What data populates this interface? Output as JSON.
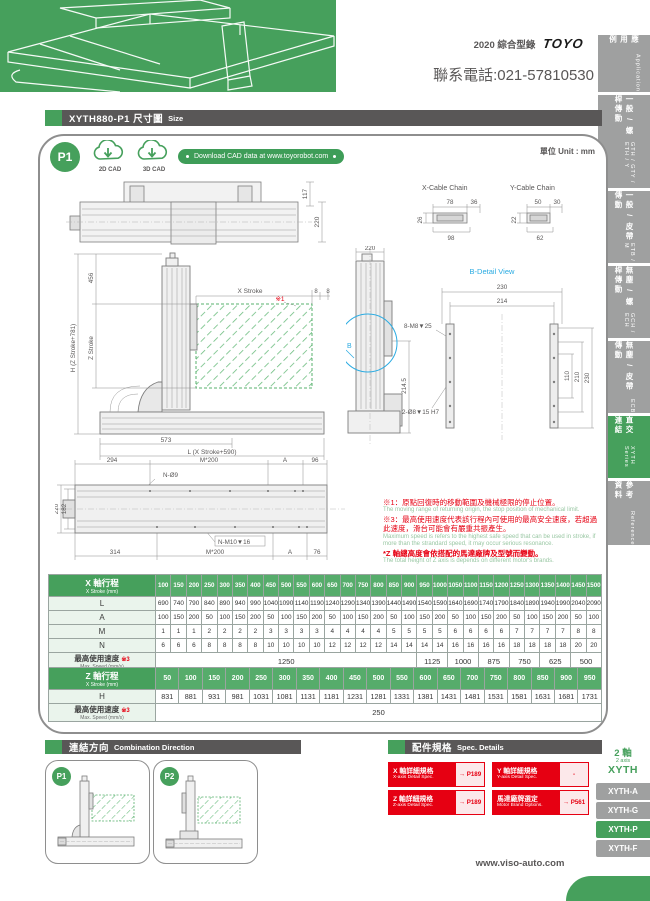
{
  "header": {
    "catalog": "2020 綜合型錄",
    "logo": "TOYO",
    "phone": "聯系電話:021-57810530"
  },
  "sidebar": {
    "items": [
      {
        "cn": "應用例",
        "en": "Application"
      },
      {
        "cn": "一般 / 螺桿傳動",
        "en": "GTH / GTY / ETH / Y"
      },
      {
        "cn": "一般 / 皮帶傳動",
        "en": "ETB / M"
      },
      {
        "cn": "無塵 / 螺桿傳動",
        "en": "GCH / ECH"
      },
      {
        "cn": "無塵 / 皮帶傳動",
        "en": "ECB"
      },
      {
        "cn": "直交連結",
        "en": "XYTH Series"
      },
      {
        "cn": "參考資料",
        "en": "Reference"
      }
    ]
  },
  "title_bar": {
    "model_label": "XYTH880-P1 尺寸圖",
    "en": "Size"
  },
  "panel_top": {
    "badge": "P1",
    "cad_2d": "2D CAD",
    "cad_3d": "3D CAD",
    "download": "Download CAD data at www.toyorobot.com",
    "unit": "單位 Unit : mm"
  },
  "drawings": {
    "top": {
      "d117": "117",
      "d220": "220"
    },
    "cable": {
      "x_title": "X-Cable Chain",
      "y_title": "Y-Cable Chain",
      "x78": "78",
      "x36": "36",
      "x26": "26",
      "x98": "98",
      "y50": "50",
      "y30": "30",
      "y22": "22",
      "y62": "62"
    },
    "front": {
      "d456": "456",
      "dH": "H (Z Stroke+781)",
      "dZ": "Z Stroke",
      "dX": "X Stroke",
      "mark": "※1",
      "d8a": "8",
      "d8b": "8",
      "d573": "573",
      "dL": "L (X Stroke+590)"
    },
    "side": {
      "d220": "220",
      "b": "B",
      "d2145": "214.5"
    },
    "bdetail": {
      "title": "B-Detail View",
      "d230t": "230",
      "d214": "214",
      "c1": "8-M8▼25",
      "c2": "2-Ø8▼15 H7",
      "d110": "110",
      "d210": "210",
      "d230r": "230"
    },
    "base": {
      "d294": "294",
      "m200t": "M*200",
      "at": "A",
      "d96": "96",
      "n9": "N-Ø9",
      "d220": "220",
      "d182": "182",
      "d314": "314",
      "m200b": "M*200",
      "ab": "A",
      "d76": "76",
      "nm10": "N-M10▼16"
    }
  },
  "notes": {
    "n1_cn": "※1：原點回復時的移動範圍及機械極限的停止位置。",
    "n1_en": "The moving range of returning origin, the stop position of mechanical limit.",
    "n3_cn": "※3：最高使用速度代表該行程內可使用的最高安全速度，若超過此速度，滑台可能會有嚴重共振產生。",
    "n3_en": "Maximum speed is refers to the highest safe speed that can be used in stroke, if more than the strandard speed, it may occur serious resonance.",
    "nz_cn": "*Z 軸總高度會依搭配的馬達廠牌及型號而變動。",
    "nz_en": "The total height of Z axis is depends on different motor's brands."
  },
  "x_table": {
    "header": "X 軸行程",
    "header_sub": "X Stroke (mm)",
    "strokes": [
      "100",
      "150",
      "200",
      "250",
      "300",
      "350",
      "400",
      "450",
      "500",
      "550",
      "600",
      "650",
      "700",
      "750",
      "800",
      "850",
      "900",
      "950",
      "1000",
      "1050",
      "1100",
      "1150",
      "1200",
      "1250",
      "1300",
      "1350",
      "1400",
      "1450",
      "1500"
    ],
    "rows": [
      {
        "label": "L",
        "values": [
          "690",
          "740",
          "790",
          "840",
          "890",
          "940",
          "990",
          "1040",
          "1090",
          "1140",
          "1190",
          "1240",
          "1290",
          "1340",
          "1390",
          "1440",
          "1490",
          "1540",
          "1590",
          "1640",
          "1690",
          "1740",
          "1790",
          "1840",
          "1890",
          "1940",
          "1990",
          "2040",
          "2090"
        ]
      },
      {
        "label": "A",
        "values": [
          "100",
          "150",
          "200",
          "50",
          "100",
          "150",
          "200",
          "50",
          "100",
          "150",
          "200",
          "50",
          "100",
          "150",
          "200",
          "50",
          "100",
          "150",
          "200",
          "50",
          "100",
          "150",
          "200",
          "50",
          "100",
          "150",
          "200",
          "50",
          "100"
        ]
      },
      {
        "label": "M",
        "values": [
          "1",
          "1",
          "1",
          "2",
          "2",
          "2",
          "2",
          "3",
          "3",
          "3",
          "3",
          "4",
          "4",
          "4",
          "4",
          "5",
          "5",
          "5",
          "5",
          "6",
          "6",
          "6",
          "6",
          "7",
          "7",
          "7",
          "7",
          "8",
          "8"
        ]
      },
      {
        "label": "N",
        "values": [
          "6",
          "6",
          "6",
          "8",
          "8",
          "8",
          "8",
          "10",
          "10",
          "10",
          "10",
          "12",
          "12",
          "12",
          "12",
          "14",
          "14",
          "14",
          "14",
          "16",
          "16",
          "16",
          "16",
          "18",
          "18",
          "18",
          "18",
          "20",
          "20"
        ]
      }
    ],
    "speed_label": "最高使用速度",
    "speed_mark": "※3",
    "speed_sub": "Max. Speed (mm/s)",
    "speed_cells": [
      {
        "value": "1250",
        "span": 17
      },
      {
        "value": "1125",
        "span": 2
      },
      {
        "value": "1000",
        "span": 2
      },
      {
        "value": "875",
        "span": 2
      },
      {
        "value": "750",
        "span": 2
      },
      {
        "value": "625",
        "span": 2
      },
      {
        "value": "500",
        "span": 2
      }
    ]
  },
  "z_table": {
    "header": "Z 軸行程",
    "header_sub": "X Stroke (mm)",
    "strokes": [
      "50",
      "100",
      "150",
      "200",
      "250",
      "300",
      "350",
      "400",
      "450",
      "500",
      "550",
      "600",
      "650",
      "700",
      "750",
      "800",
      "850",
      "900",
      "950"
    ],
    "rows": [
      {
        "label": "H",
        "values": [
          "831",
          "881",
          "931",
          "981",
          "1031",
          "1081",
          "1131",
          "1181",
          "1231",
          "1281",
          "1331",
          "1381",
          "1431",
          "1481",
          "1531",
          "1581",
          "1631",
          "1681",
          "1731"
        ]
      }
    ],
    "speed_label": "最高使用速度",
    "speed_mark": "※3",
    "speed_sub": "Max. Speed (mm/s)",
    "speed_cells": [
      {
        "value": "250",
        "span": 19
      }
    ]
  },
  "combination": {
    "cards": [
      {
        "label": "P1"
      },
      {
        "label": "P2"
      }
    ]
  },
  "comb_bar": {
    "cn": "連結方向",
    "en": "Combination Direction"
  },
  "spec_bar": {
    "cn": "配件規格",
    "en": "Spec. Details"
  },
  "spec": {
    "items": [
      {
        "cn": "X 軸詳細規格",
        "en": "X-axis Detail Spec.",
        "link": "→ P189"
      },
      {
        "cn": "Y 軸詳細規格",
        "en": "Y-axis Detail Spec.",
        "link": "-"
      },
      {
        "cn": "Z 軸詳細規格",
        "en": "Z-axis Detail Spec.",
        "link": "→ P189"
      },
      {
        "cn": "馬達廠牌選定",
        "en": "Motor Brand Options.",
        "link": "→ P561"
      }
    ]
  },
  "series": {
    "axis_cn": "2 軸",
    "axis_en": "2 axis",
    "name": "XYTH",
    "tabs": [
      {
        "label": "XYTH-A"
      },
      {
        "label": "XYTH-G"
      },
      {
        "label": "XYTH-P"
      },
      {
        "label": "XYTH-F"
      }
    ]
  },
  "footer": {
    "url": "www.viso-auto.com"
  }
}
